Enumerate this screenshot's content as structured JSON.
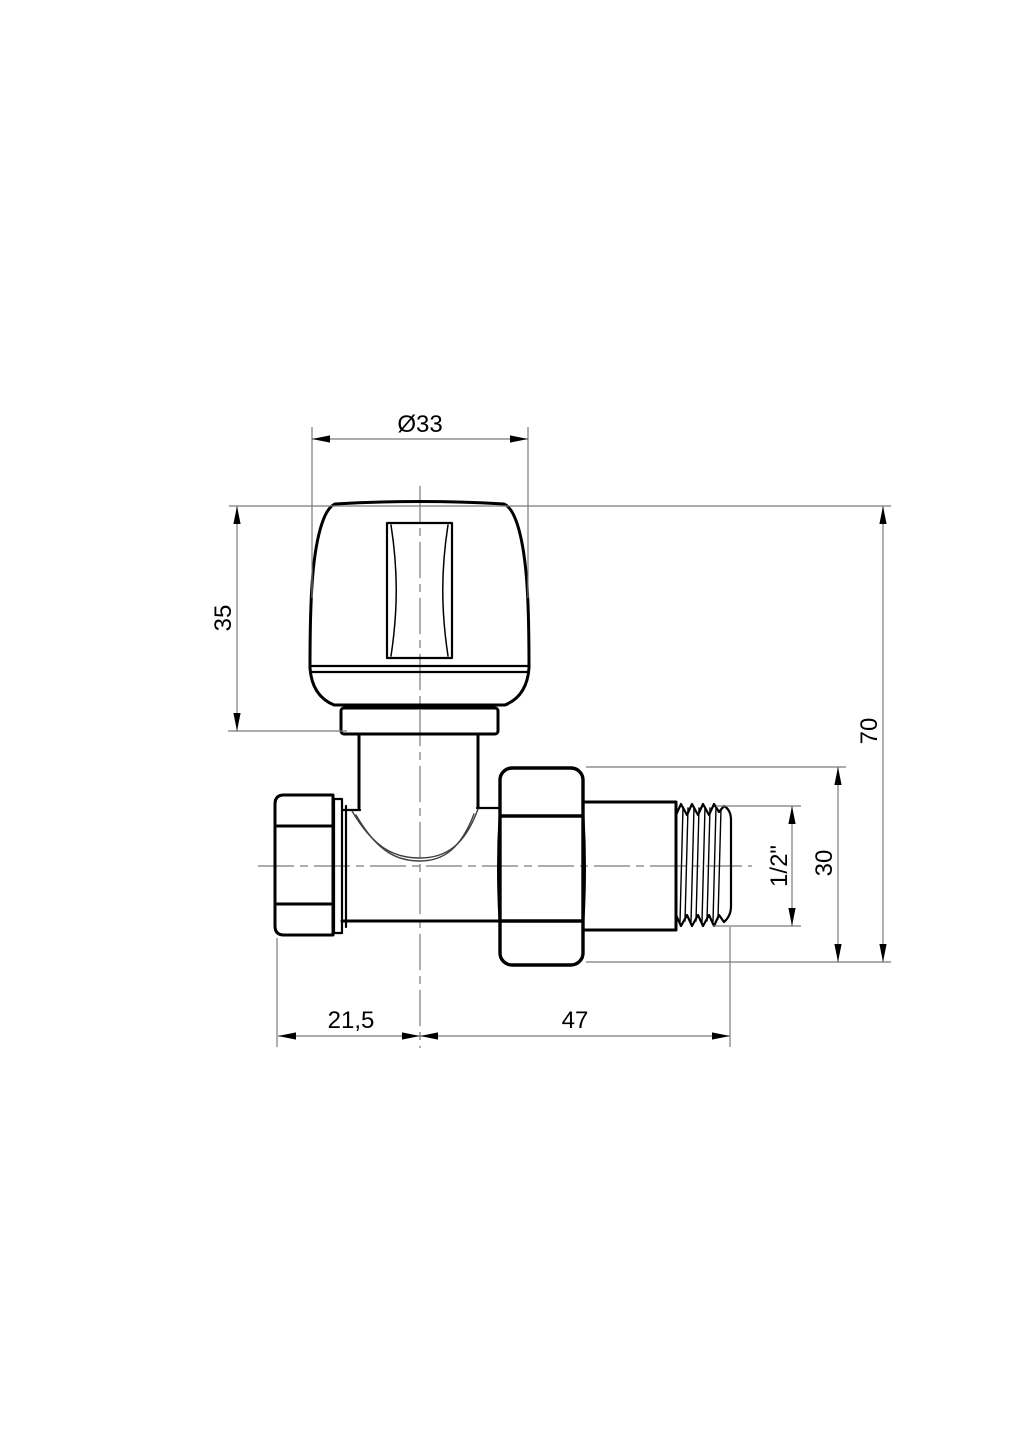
{
  "drawing": {
    "dimensions": {
      "knob_diameter": "Ø33",
      "knob_height": "35",
      "total_height": "70",
      "union_nut_height": "30",
      "thread_size": "1/2\"",
      "left_end_length": "21,5",
      "body_length": "47"
    },
    "colors": {
      "background": "#ffffff",
      "object_line": "#000000",
      "thin_line": "#7a7a7a",
      "seam_line": "#3f3f3f",
      "text": "#000000"
    }
  }
}
